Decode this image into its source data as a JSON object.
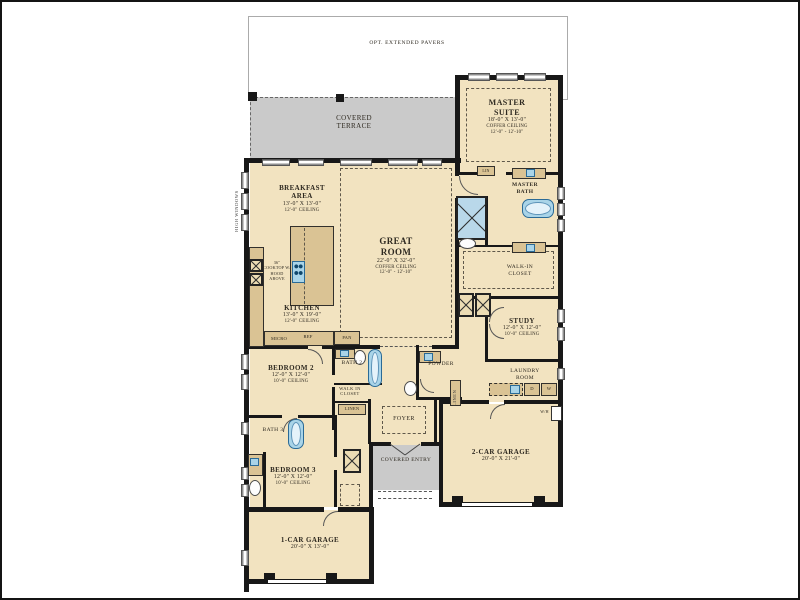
{
  "colors": {
    "room_fill": "#f2e3c0",
    "cabinet_fill": "#dac394",
    "outdoor_gray": "#cacaca",
    "wall_black": "#181818",
    "fixture_blue": "#a9d4e8",
    "fixture_blue_border": "#2a6a96"
  },
  "site": {
    "pavers_label": "OPT. EXTENDED PAVERS",
    "high_windows_label": "HIGH WINDOWS"
  },
  "outdoor": {
    "terrace": "COVERED TERRACE",
    "entry": "COVERED ENTRY"
  },
  "rooms": {
    "master_suite": {
      "name": "MASTER SUITE",
      "dims": "18'-0\" X 13'-0\"",
      "ceiling": "COFFER CEILING",
      "ceiling_hts": "12'-0\" - 12'-10\""
    },
    "master_bath": {
      "name": "MASTER BATH"
    },
    "master_closet": {
      "name": "WALK-IN CLOSET"
    },
    "breakfast": {
      "name": "BREAKFAST AREA",
      "dims": "13'-0\" X 13'-0\"",
      "ceiling": "12'-0\" CEILING"
    },
    "great_room": {
      "name": "GREAT ROOM",
      "dims": "22'-0\" X 32'-0\"",
      "ceiling": "COFFER CEILING",
      "ceiling_hts": "12'-0\" - 12'-10\""
    },
    "kitchen": {
      "name": "KITCHEN",
      "dims": "13'-0\" X 19'-0\"",
      "ceiling": "12'-0\" CEILING"
    },
    "study": {
      "name": "STUDY",
      "dims": "12'-0\" X 12'-0\"",
      "ceiling": "10'-0\" CEILING"
    },
    "powder": {
      "name": "POWDER"
    },
    "laundry": {
      "name": "LAUNDRY ROOM"
    },
    "foyer": {
      "name": "FOYER"
    },
    "bedroom2": {
      "name": "BEDROOM 2",
      "dims": "12'-0\" X 12'-0\"",
      "ceiling": "10'-0\" CEILING"
    },
    "bath2": {
      "name": "BATH 2"
    },
    "bedroom2_closet": {
      "name": "WALK IN CLOSET"
    },
    "bedroom3": {
      "name": "BEDROOM 3",
      "dims": "12'-0\" X 12'-0\"",
      "ceiling": "10'-0\" CEILING"
    },
    "bath3": {
      "name": "BATH 3"
    },
    "garage_2car": {
      "name": "2-CAR GARAGE",
      "dims": "20'-0\" X 21'-0\""
    },
    "garage_1car": {
      "name": "1-CAR GARAGE",
      "dims": "20'-0\" X 13'-0\""
    }
  },
  "closets": {
    "lin": "LIN",
    "linen_hall": "LINEN",
    "linen_powder": "LINEN"
  },
  "appliances": {
    "cooktop_note": "36\" COOKTOP W/ HOOD ABOVE",
    "micro": "MICRO",
    "ref": "REF",
    "pantry": "PAN",
    "dryer": "D",
    "washer": "W",
    "water_heater": "W/H"
  }
}
